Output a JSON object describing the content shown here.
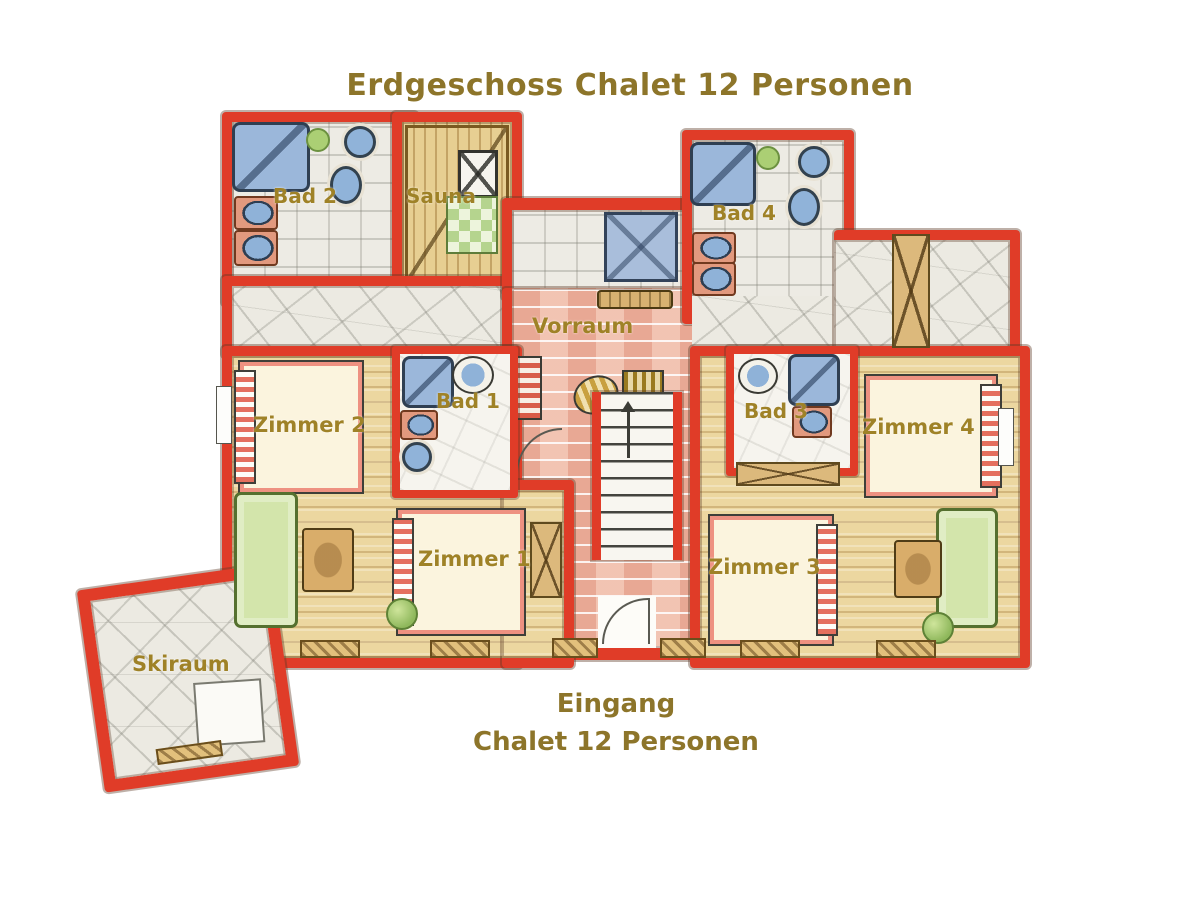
{
  "title": "Erdgeschoss Chalet 12 Personen",
  "caption": {
    "line1": "Eingang",
    "line2": "Chalet 12 Personen"
  },
  "rooms": {
    "bad2": "Bad 2",
    "sauna": "Sauna",
    "bad4": "Bad 4",
    "vorraum": "Vorraum",
    "bad1": "Bad 1",
    "bad3": "Bad 3",
    "zimmer2": "Zimmer 2",
    "zimmer4": "Zimmer 4",
    "zimmer1": "Zimmer 1",
    "zimmer3": "Zimmer 3",
    "skiraum": "Skiraum"
  },
  "colors": {
    "wall_red": "#e03c28",
    "title_gold": "#8d752a",
    "label_gold": "#9f8227",
    "wood_floor": "#ecd7a0",
    "sauna_wood": "#e7cf92",
    "brick_pink": "#f1c9b8",
    "stone_gray": "#edebe4",
    "fixture_blue": "#9bb7da",
    "sofa_green": "#d3e5ab",
    "plant_green": "#8fb85c",
    "bed_cream": "#fbf4de",
    "bed_trim_pink": "#ee9181",
    "wardrobe_tan": "#dcb97c"
  }
}
